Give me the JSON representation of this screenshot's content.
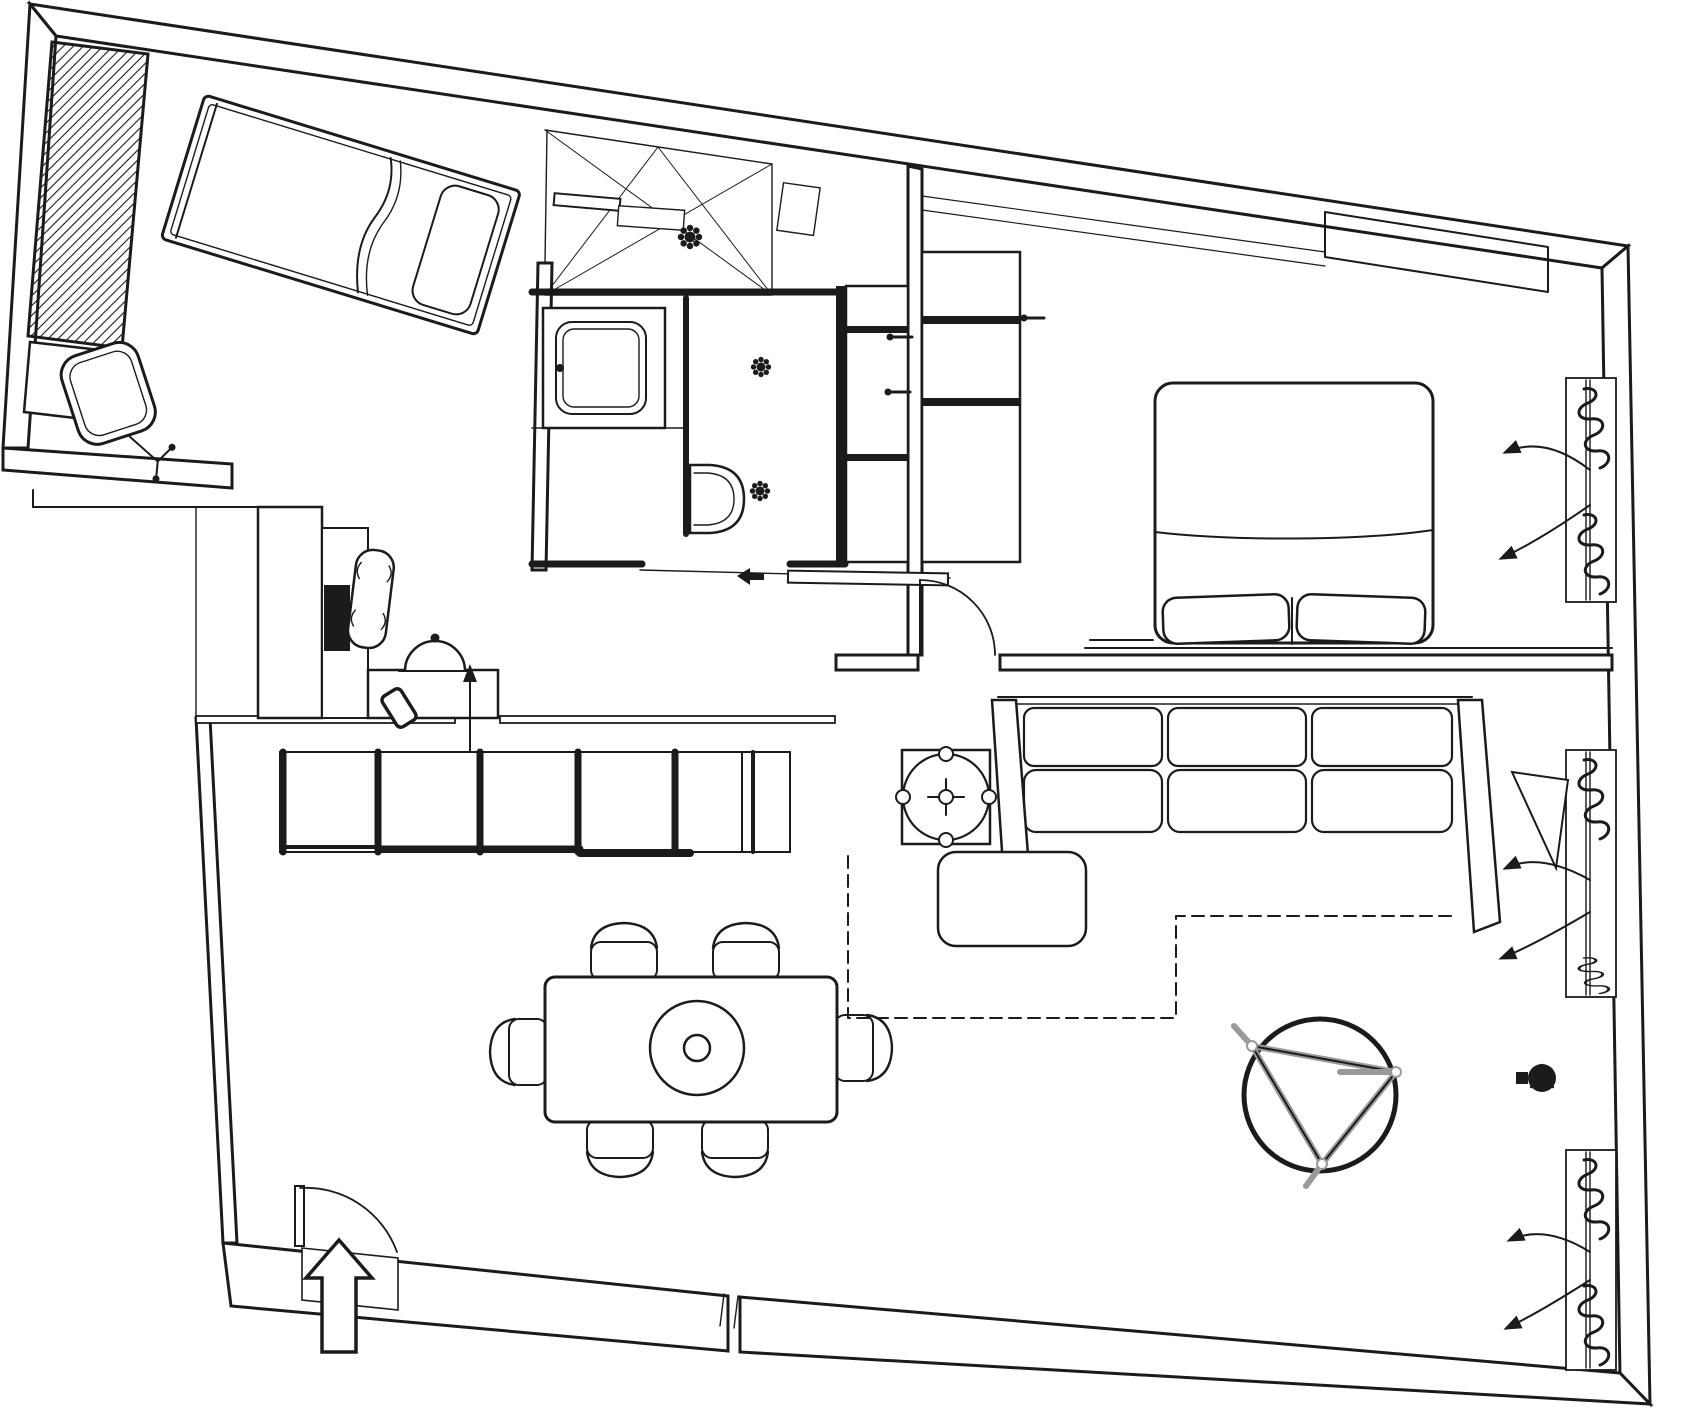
{
  "figure": {
    "label": "apartment-floor-plan",
    "type": "architectural-plan-line-drawing"
  },
  "colors": {
    "background": "#ffffff",
    "line": "#1b1b1b",
    "frame_gray": "#9a9a9a"
  },
  "rooms": [
    {
      "id": "bedroom-upper-left",
      "contents": [
        "hatched-wardrobe",
        "low-cabinet",
        "single-bed-angled",
        "office-swivel-chair"
      ]
    },
    {
      "id": "shower-area-sloped-ceiling",
      "contents": [
        "shower-tray-cross-lines",
        "shower-bar",
        "shower-bench",
        "drain-rosette"
      ]
    },
    {
      "id": "bathroom",
      "contents": [
        "washbasin-counter",
        "wall-fixture-toilet",
        "ceiling-spotlight",
        "ceiling-spotlight",
        "tall-cabinet-column",
        "sliding-door"
      ]
    },
    {
      "id": "hallway",
      "contents": [
        "shelf-column",
        "desk",
        "monitor",
        "desk-chair",
        "side-table",
        "dome-lamp",
        "phone",
        "direction-arrow-up"
      ]
    },
    {
      "id": "bedroom-right",
      "contents": [
        "closet-column",
        "double-bed",
        "pillows",
        "bed-platform-line",
        "hinged-door",
        "window-with-curtains",
        "ceiling-bulkhead"
      ]
    },
    {
      "id": "living-dining-room",
      "contents": [
        "kitchen-sideboard",
        "dining-table",
        "dining-chairs-x6",
        "plant-side-table",
        "three-seat-sofa",
        "sofa-chaise",
        "sofa-bed-dashed-outline",
        "round-lounge-chair",
        "radiator-valve",
        "window-with-curtains",
        "window-with-curtains",
        "entrance-door",
        "entrance-block-arrow"
      ]
    }
  ],
  "symbols": [
    {
      "id": "curtain-squiggle",
      "meaning": "window curtain in plan"
    },
    {
      "id": "flower-rosette",
      "meaning": "ceiling spot / drain"
    },
    {
      "id": "block-arrow",
      "meaning": "main entrance direction"
    },
    {
      "id": "quarter-arc",
      "meaning": "door swing"
    },
    {
      "id": "dashed-rectangle",
      "meaning": "sofa-bed pull-out extent"
    }
  ],
  "counts": {
    "dining_chairs": 6,
    "windows_with_curtains": 3,
    "ceiling_spotlights": 2,
    "beds": 2,
    "doors": 4
  }
}
